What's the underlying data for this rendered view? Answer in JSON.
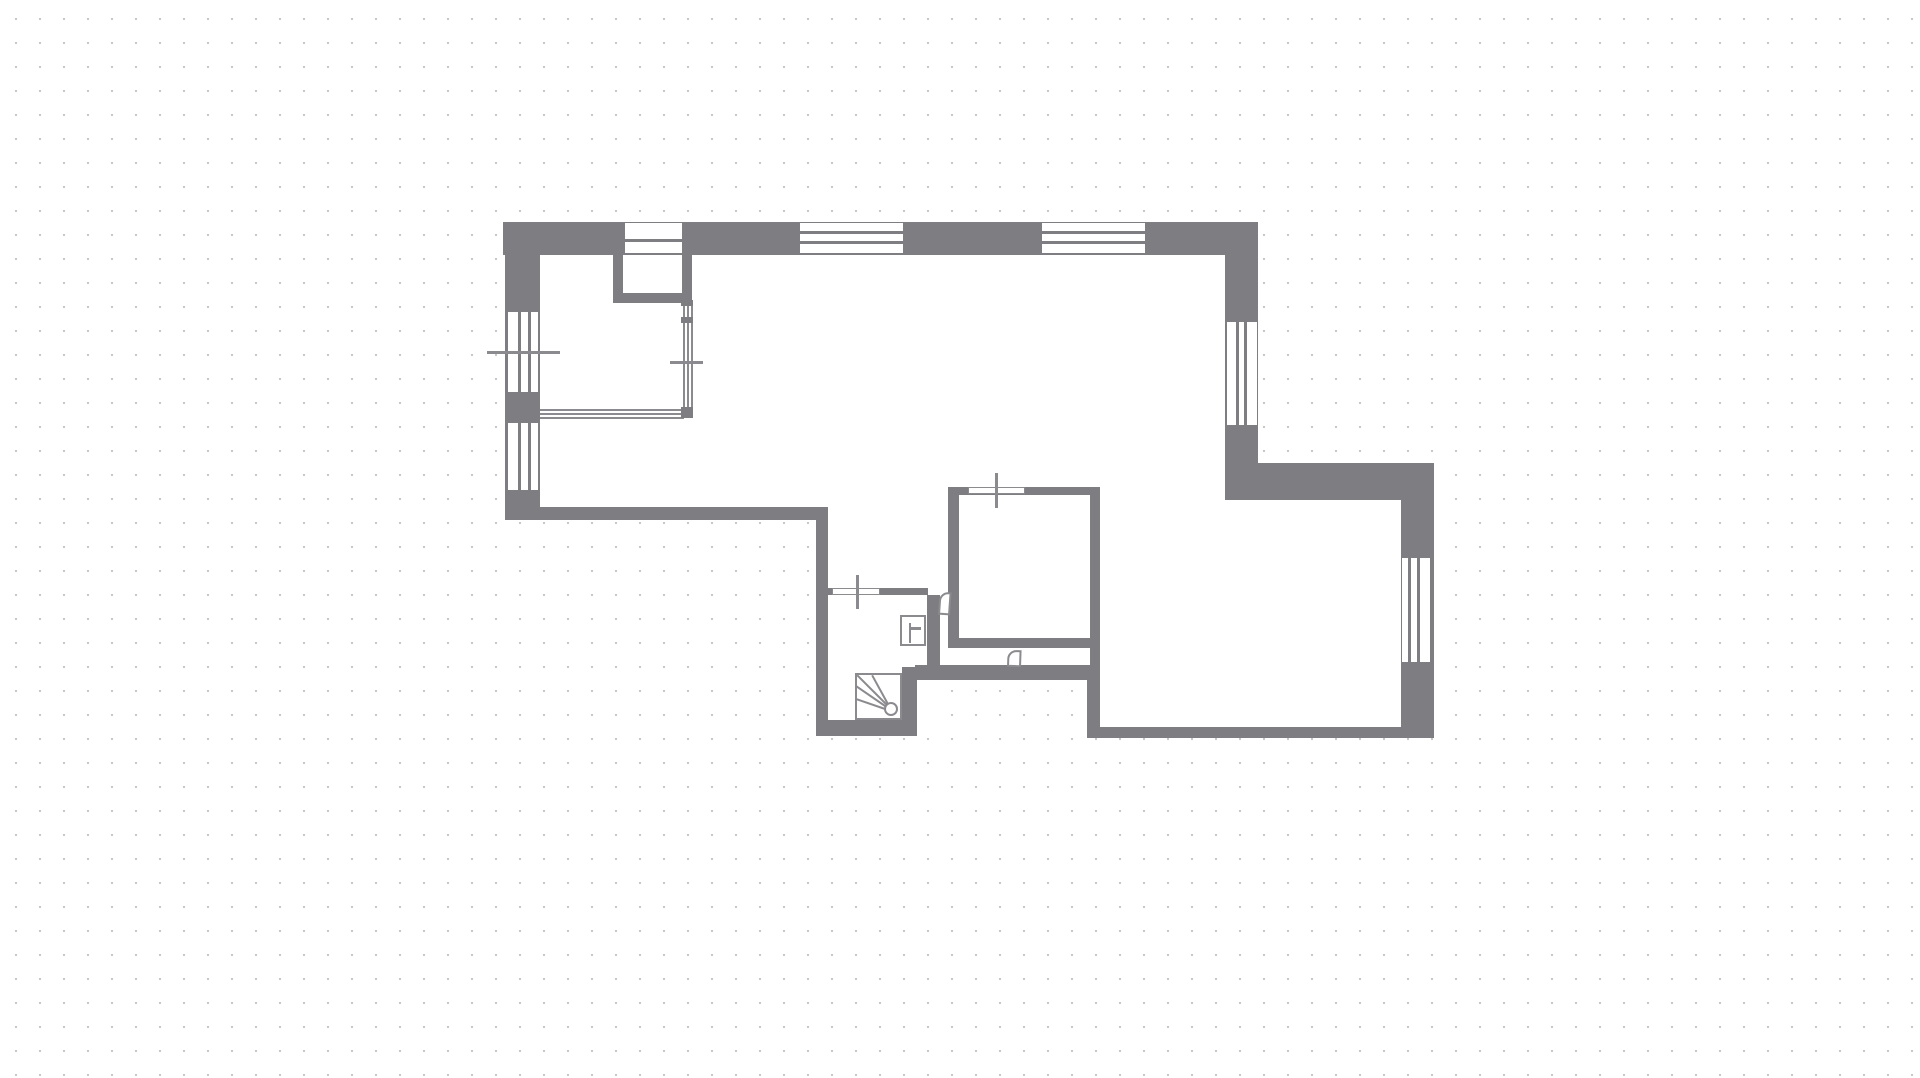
{
  "canvas": {
    "width": 1920,
    "height": 1078,
    "background_color": "#ffffff",
    "grid_dot_color": "#c8c8c8",
    "grid_spacing_px": 24,
    "wall_color": "#7e7e82",
    "line_color": "#8b8b8f",
    "floor_color": "#ffffff"
  },
  "floor_plan": {
    "interiors": [
      {
        "name": "floor-top-room",
        "x": 540,
        "y": 255,
        "w": 683,
        "h": 255
      },
      {
        "name": "floor-hallway",
        "x": 828,
        "y": 510,
        "w": 120,
        "h": 210
      },
      {
        "name": "floor-bedroom-block",
        "x": 948,
        "y": 487,
        "w": 152,
        "h": 193
      },
      {
        "name": "floor-bottom-right-room",
        "x": 1098,
        "y": 495,
        "w": 304,
        "h": 232
      }
    ],
    "walls": [
      {
        "name": "wall-top-exterior",
        "x": 503,
        "y": 222,
        "w": 755,
        "h": 33
      },
      {
        "name": "wall-left-exterior",
        "x": 505,
        "y": 222,
        "w": 35,
        "h": 298
      },
      {
        "name": "wall-bottom-left",
        "x": 505,
        "y": 507,
        "w": 323,
        "h": 13
      },
      {
        "name": "wall-right-upper-exterior",
        "x": 1225,
        "y": 255,
        "w": 33,
        "h": 208
      },
      {
        "name": "wall-step-exterior",
        "x": 1225,
        "y": 463,
        "w": 209,
        "h": 37
      },
      {
        "name": "wall-right-lower-exterior",
        "x": 1401,
        "y": 463,
        "w": 33,
        "h": 275
      },
      {
        "name": "wall-bottom-right-exterior",
        "x": 1087,
        "y": 727,
        "w": 347,
        "h": 11
      },
      {
        "name": "wall-bottom-room-left",
        "x": 1087,
        "y": 665,
        "w": 13,
        "h": 73
      },
      {
        "name": "wall-hall-left",
        "x": 816,
        "y": 520,
        "w": 12,
        "h": 216
      },
      {
        "name": "wall-stair-bottom",
        "x": 816,
        "y": 720,
        "w": 101,
        "h": 16
      },
      {
        "name": "wall-stair-right",
        "x": 902,
        "y": 667,
        "w": 15,
        "h": 69
      },
      {
        "name": "wall-mid-thick",
        "x": 915,
        "y": 665,
        "w": 185,
        "h": 15
      },
      {
        "name": "wall-wc-top",
        "x": 828,
        "y": 588,
        "w": 100,
        "h": 7
      },
      {
        "name": "wall-wc-right",
        "x": 927,
        "y": 595,
        "w": 13,
        "h": 73
      },
      {
        "name": "wall-bedroom-left",
        "x": 948,
        "y": 487,
        "w": 11,
        "h": 161
      },
      {
        "name": "wall-bedroom-top",
        "x": 948,
        "y": 487,
        "w": 152,
        "h": 8
      },
      {
        "name": "wall-bedroom-right",
        "x": 1090,
        "y": 487,
        "w": 10,
        "h": 178
      },
      {
        "name": "wall-bedroom-bottom",
        "x": 952,
        "y": 638,
        "w": 148,
        "h": 10
      },
      {
        "name": "wall-niche-left",
        "x": 613,
        "y": 255,
        "w": 10,
        "h": 48
      },
      {
        "name": "wall-niche-right",
        "x": 682,
        "y": 255,
        "w": 10,
        "h": 48
      },
      {
        "name": "wall-niche-bottom",
        "x": 613,
        "y": 293,
        "w": 79,
        "h": 10
      }
    ],
    "windows": [
      {
        "name": "window-top-a",
        "x": 625,
        "y": 223,
        "w": 57,
        "h": 30,
        "orientation": "h",
        "mullions": [
          239
        ]
      },
      {
        "name": "window-top-b",
        "x": 800,
        "y": 223,
        "w": 103,
        "h": 30,
        "orientation": "h",
        "mullions": [
          231,
          241
        ]
      },
      {
        "name": "window-top-c",
        "x": 1042,
        "y": 223,
        "w": 103,
        "h": 30,
        "orientation": "h",
        "mullions": [
          231,
          241
        ]
      },
      {
        "name": "window-left-d",
        "x": 508,
        "y": 312,
        "w": 30,
        "h": 80,
        "orientation": "v",
        "mullions": [
          518,
          528
        ]
      },
      {
        "name": "window-left-e",
        "x": 508,
        "y": 423,
        "w": 30,
        "h": 67,
        "orientation": "v",
        "mullions": [
          518,
          528
        ]
      },
      {
        "name": "window-right-f",
        "x": 1227,
        "y": 322,
        "w": 30,
        "h": 103,
        "orientation": "v",
        "mullions": [
          1236,
          1244
        ]
      },
      {
        "name": "window-right-g",
        "x": 1402,
        "y": 558,
        "w": 28,
        "h": 104,
        "orientation": "v",
        "mullions": [
          1408,
          1417
        ]
      }
    ],
    "opening_markers": [
      {
        "name": "door-marker-hall",
        "slot": {
          "x": 832,
          "y": 588,
          "w": 48,
          "h": 7
        },
        "tick": {
          "x": 856,
          "y": 575,
          "w": 3,
          "h": 34
        }
      },
      {
        "name": "door-marker-bedroom-top",
        "slot": {
          "x": 968,
          "y": 487,
          "w": 57,
          "h": 7
        },
        "tick": {
          "x": 995,
          "y": 473,
          "w": 3,
          "h": 35
        }
      }
    ],
    "cross_markers": [
      {
        "name": "window-marker-left-wall",
        "x": 487,
        "y": 351,
        "w": 73,
        "h": 3
      },
      {
        "name": "opening-marker-glazing",
        "x": 670,
        "y": 361,
        "w": 33,
        "h": 3
      }
    ],
    "glazing": {
      "vertical_lines": [
        {
          "x": 683,
          "y": 305,
          "w": 2,
          "h": 104
        },
        {
          "x": 687,
          "y": 305,
          "w": 2,
          "h": 104
        },
        {
          "x": 691,
          "y": 305,
          "w": 2,
          "h": 104
        }
      ],
      "horizontal_lines": [
        {
          "x": 540,
          "y": 409,
          "w": 144,
          "h": 2
        },
        {
          "x": 540,
          "y": 413,
          "w": 144,
          "h": 2
        },
        {
          "x": 540,
          "y": 417,
          "w": 144,
          "h": 2
        }
      ],
      "blocks": [
        {
          "name": "glazing-joint-top",
          "x": 681,
          "y": 300,
          "w": 12,
          "h": 6
        },
        {
          "name": "glazing-joint-mid",
          "x": 681,
          "y": 317,
          "w": 12,
          "h": 6
        },
        {
          "name": "glazing-joint-corner",
          "x": 681,
          "y": 407,
          "w": 12,
          "h": 11
        }
      ]
    },
    "stairs": {
      "box": {
        "x": 855,
        "y": 673,
        "w": 47,
        "h": 47
      },
      "newel": {
        "x": 884,
        "y": 702,
        "w": 14,
        "h": 14
      },
      "fan_lines": [
        {
          "x1": 889,
          "y1": 707,
          "x2": 857,
          "y2": 675
        },
        {
          "x1": 889,
          "y1": 706,
          "x2": 872,
          "y2": 675
        },
        {
          "x1": 888,
          "y1": 708,
          "x2": 856,
          "y2": 686
        },
        {
          "x1": 888,
          "y1": 710,
          "x2": 856,
          "y2": 699
        }
      ]
    },
    "door_leaves": [
      {
        "name": "wc-door-leaf",
        "x": 938,
        "y": 592,
        "w": 12,
        "h": 23,
        "rot": 4
      },
      {
        "name": "bedroom-door-leaf",
        "x": 1007,
        "y": 650,
        "w": 14,
        "h": 17,
        "rot": 2
      }
    ],
    "fixtures": {
      "wc_box": {
        "name": "wc-fixture-box",
        "x": 900,
        "y": 615,
        "w": 26,
        "h": 31
      },
      "wc_symbol_lines": [
        {
          "name": "wc-fixture-symbol-v",
          "x": 909,
          "y": 623,
          "w": 2,
          "h": 20
        },
        {
          "name": "wc-fixture-symbol-h",
          "x": 910,
          "y": 627,
          "w": 11,
          "h": 3
        }
      ]
    }
  }
}
